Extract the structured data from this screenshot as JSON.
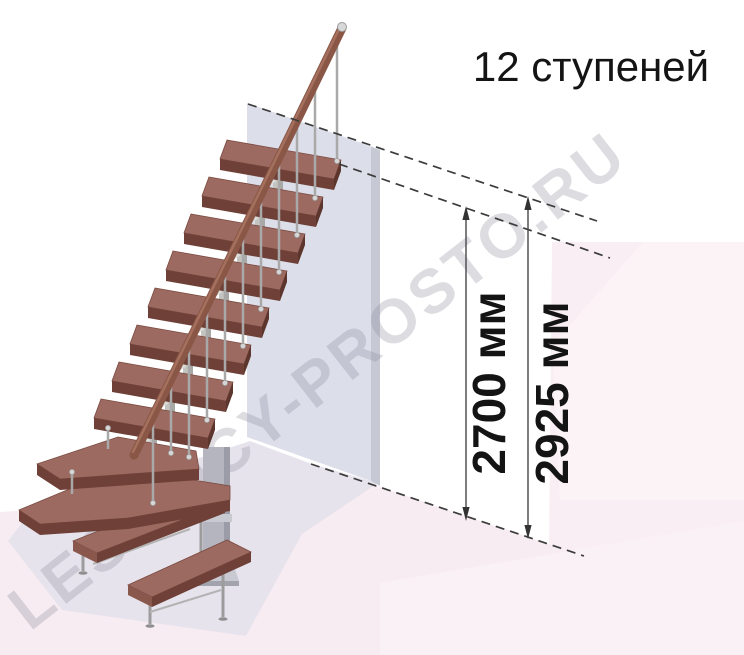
{
  "title": {
    "text": "12 ступеней"
  },
  "watermark": {
    "text": "LESTNICY-PROSTO.RU"
  },
  "dimensions": {
    "inner": {
      "label": "2700 мм",
      "value": 2700,
      "unit": "мм"
    },
    "outer": {
      "label": "2925 мм",
      "value": 2925,
      "unit": "мм"
    }
  },
  "staircase": {
    "steps_count": 12,
    "colors": {
      "tread_top": "#9c6a60",
      "tread_front": "#6e4037",
      "handrail": "#8a5747",
      "metal": "#c3c3c0",
      "wall": "#dcdee9",
      "floor": "#f7ecf2",
      "floor_shadow": "#e7e3ec",
      "background_panel": "#f9eef3",
      "annotation": "#3c3c3c"
    }
  }
}
